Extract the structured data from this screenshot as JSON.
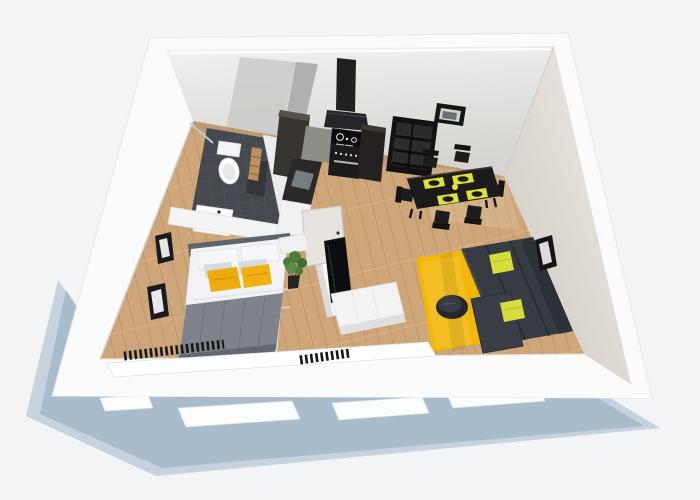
{
  "scene": {
    "type": "3d-floor-plan-render",
    "description": "Isometric cut-away 3D render of a one-bedroom apartment viewed from above; white cut walls, light oak flooring, dark graphite furniture with yellow accents, blue-grey cast shadow on a white backdrop. No text labels are present in the image.",
    "rooms": [
      {
        "id": "bathroom",
        "label": "Bathroom"
      },
      {
        "id": "kitchen",
        "label": "Kitchen"
      },
      {
        "id": "dining-area",
        "label": "Dining area"
      },
      {
        "id": "living-room",
        "label": "Living room"
      },
      {
        "id": "bedroom",
        "label": "Bedroom"
      },
      {
        "id": "hallway",
        "label": "Hallway"
      },
      {
        "id": "balcony",
        "label": "Balcony / loggia"
      }
    ],
    "furniture": [
      {
        "id": "toilet",
        "label": "Toilet",
        "count": 1
      },
      {
        "id": "bathroom-vanity",
        "label": "Vanity with washbasin",
        "count": 1
      },
      {
        "id": "shower-glass",
        "label": "Shower glass panel",
        "count": 1
      },
      {
        "id": "towel-ladder",
        "label": "Wooden towel ladder",
        "count": 1
      },
      {
        "id": "range-hood",
        "label": "Black chimney range hood",
        "count": 1
      },
      {
        "id": "stove",
        "label": "Range cooker with cooktop",
        "count": 1
      },
      {
        "id": "tall-cabinet",
        "label": "Tall kitchen cabinets",
        "count": 2
      },
      {
        "id": "kitchen-peninsula",
        "label": "Kitchen peninsula counter",
        "count": 1
      },
      {
        "id": "shelving-unit",
        "label": "Open black shelving unit",
        "count": 1
      },
      {
        "id": "dining-table",
        "label": "Dark dining table",
        "count": 1
      },
      {
        "id": "dining-chair",
        "label": "Black dining chairs",
        "count": 6
      },
      {
        "id": "placemat",
        "label": "Yellow placemats with plates",
        "count": 4
      },
      {
        "id": "sofa",
        "label": "Graphite corner sofa with chaise",
        "count": 1
      },
      {
        "id": "sofa-pillow",
        "label": "Yellow-green sofa pillows",
        "count": 2
      },
      {
        "id": "coffee-table",
        "label": "Round dark ottoman table",
        "count": 1
      },
      {
        "id": "rug",
        "label": "Yellow area rug",
        "count": 1
      },
      {
        "id": "tv",
        "label": "Wall-mounted TV on divider",
        "count": 1
      },
      {
        "id": "tv-lowboard",
        "label": "White TV lowboard",
        "count": 1
      },
      {
        "id": "interior-door",
        "label": "Interior door leaf",
        "count": 1
      },
      {
        "id": "double-bed",
        "label": "Double bed, grey blanket",
        "count": 1
      },
      {
        "id": "bed-pillow-yellow",
        "label": "Yellow bed pillows",
        "count": 2
      },
      {
        "id": "nightstand",
        "label": "White bedside unit",
        "count": 1
      },
      {
        "id": "plant",
        "label": "Potted green plant",
        "count": 1
      },
      {
        "id": "wall-frame",
        "label": "Black picture frames",
        "count": 4
      },
      {
        "id": "radiator",
        "label": "Black slatted radiators",
        "count": 2
      },
      {
        "id": "window-frame-slab",
        "label": "White cut window frames",
        "count": 5
      }
    ]
  },
  "palette": {
    "background": "#f3f4f5",
    "shadow": "#a9bccc",
    "shadow_soft": "#c6d3de",
    "wall_white": "#fbfbfc",
    "wall_top_light": "#f1f0ee",
    "wall_top_dark": "#d6d4d1",
    "wall_right_light": "#f0ece7",
    "wall_right_dark": "#cfc8c1",
    "bath_wall_gray": "#b2b0af",
    "floor_wood": "#cfa67a",
    "floor_wood_seam": "#b08759",
    "floor_tile": "#45484e",
    "tile_line": "#54575d",
    "accent_rug": "#f2b705",
    "accent_bed_pillow": "#eeab0d",
    "accent_sofa_pillow": "#d8dd3e",
    "accent_placemat": "#dfe038",
    "sofa_body": "#373c43",
    "sofa_back": "#2c3137",
    "bed_blanket": "#7f848c",
    "linen_white": "#f2f2f4",
    "furniture_black": "#1c1b1c",
    "furniture_dark": "#262321",
    "plant_green": "#4e7a3c",
    "door_gray": "#e7e4e0"
  }
}
